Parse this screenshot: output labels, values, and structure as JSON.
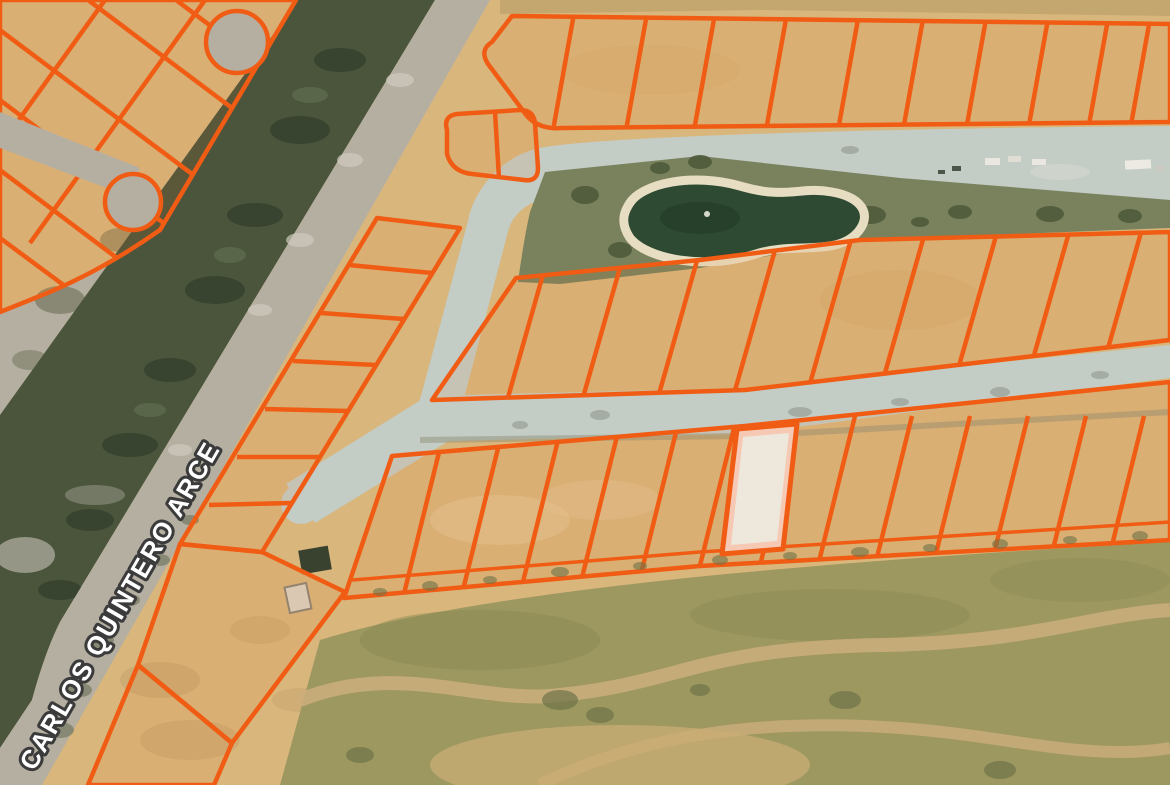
{
  "map": {
    "street_label": "CARLOS QUINTERO ARCE",
    "selected_parcel": {
      "status": "selected"
    }
  },
  "colors": {
    "parcel_line": "#f05c14",
    "parcel_tint": "rgba(238,120,40,0.10)",
    "selected_fill": "#eee7dc",
    "selected_halo": "#f6c9b4",
    "sand": "#d9b67c",
    "road": "#c3ccc5",
    "canal_green": "#4a553c",
    "pond": "#2e4a33",
    "pond_rim": "#e7ddc2",
    "grass": "#79825d",
    "gravel": "#b5afa2",
    "terrain_olive": "#9d9760",
    "label_fill": "#ffffff",
    "label_outline": "#3b3b3b"
  }
}
